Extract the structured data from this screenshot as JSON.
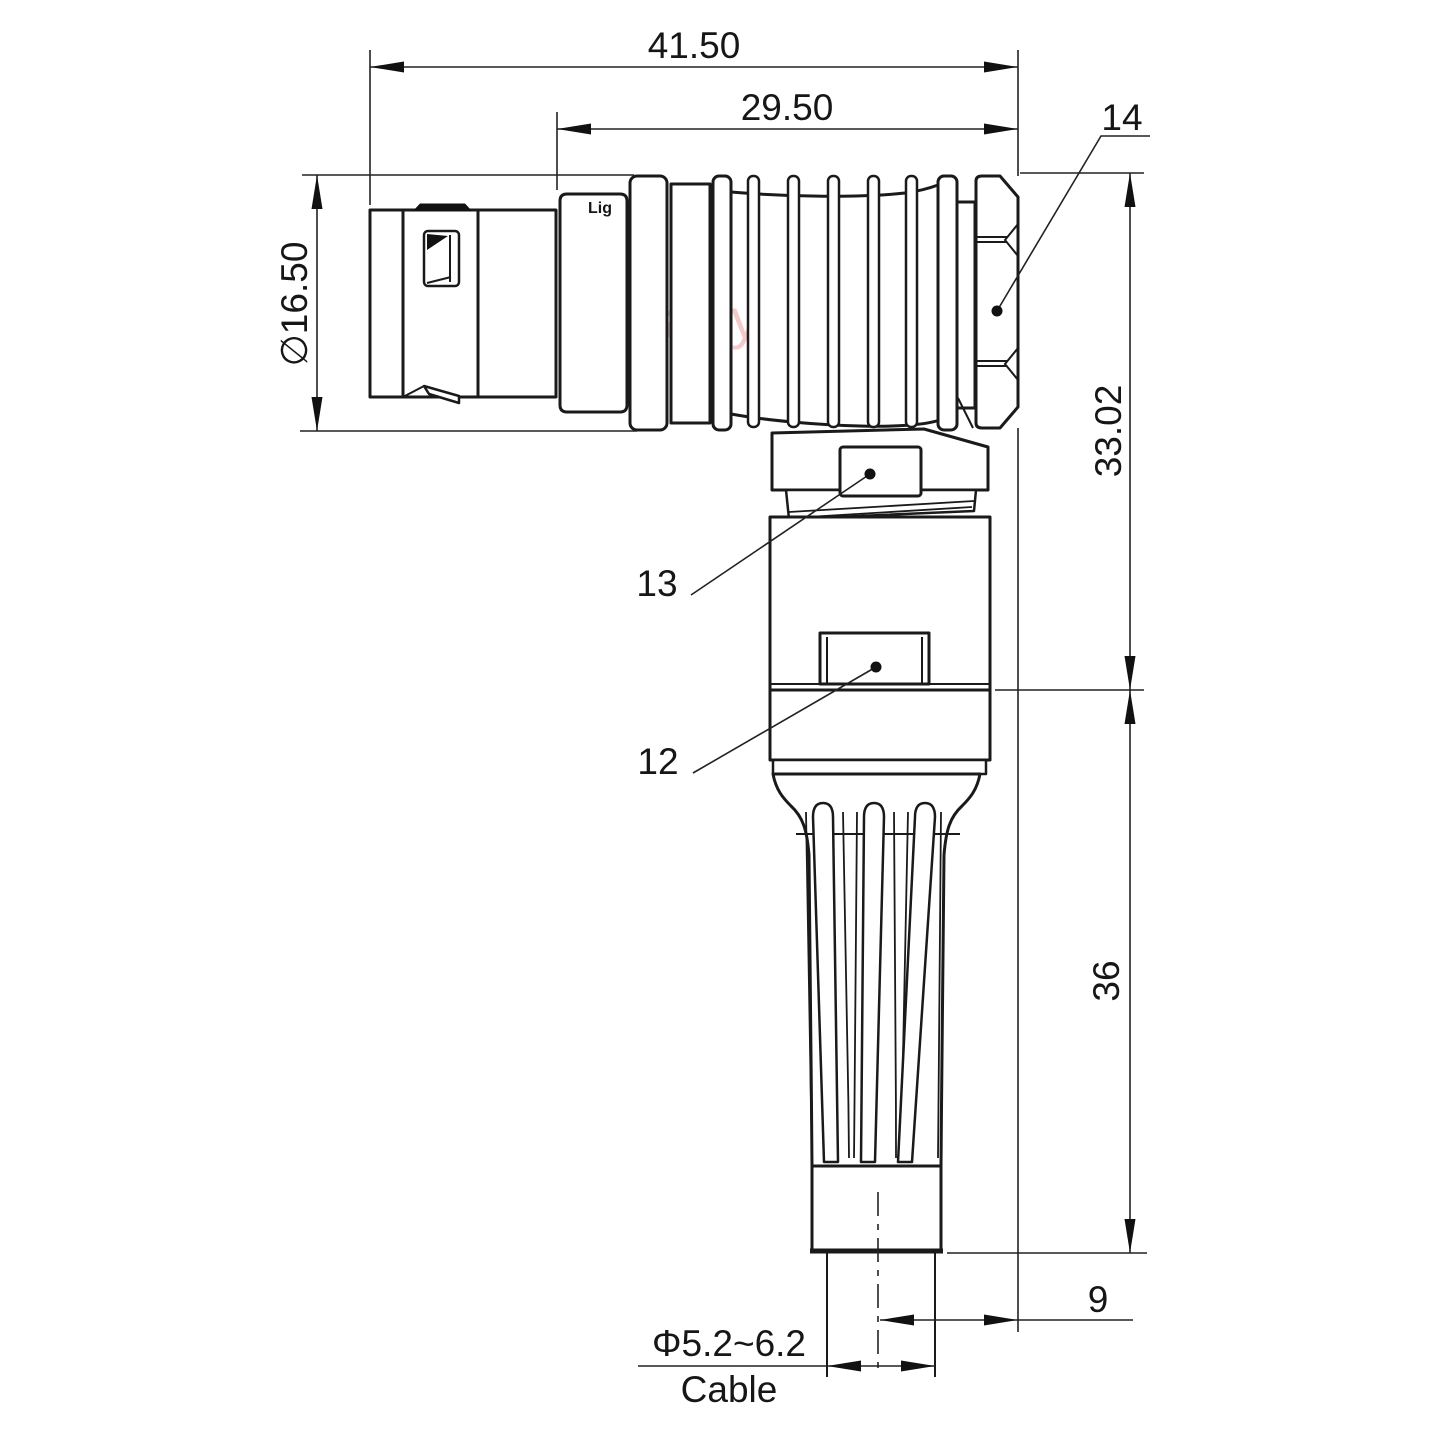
{
  "watermark_text": "Lightany",
  "connector_print": "Lig",
  "dimensions": {
    "overall_length": "41.50",
    "rear_section_length": "29.50",
    "front_diameter": "∅16.50",
    "upper_height": "33.02",
    "lower_height": "36",
    "cable_offset": "9",
    "cable_diameter_range": "Φ5.2~6.2",
    "cable_label": "Cable"
  },
  "part_labels": {
    "nut": "14",
    "coupling_ring": "13",
    "body": "12"
  }
}
